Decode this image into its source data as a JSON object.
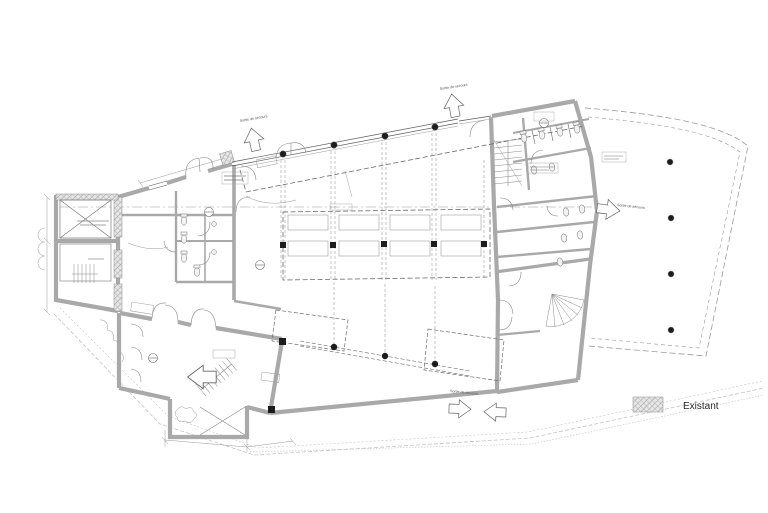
{
  "drawing": {
    "type": "architectural-floor-plan",
    "legend": {
      "label": "Existant"
    },
    "exits": [
      {
        "text": "Sortie de secours"
      },
      {
        "text": "Sortie de secours"
      },
      {
        "text": "Sortie de secours"
      },
      {
        "text": "Sortie de secours"
      }
    ],
    "colors": {
      "background": "#ffffff",
      "line": "#4a4a4a",
      "wall": "#a9a9a9",
      "dashed": "#6b6b6b",
      "site": "#c4c4c4",
      "hatch": "#9a9a9a"
    }
  }
}
